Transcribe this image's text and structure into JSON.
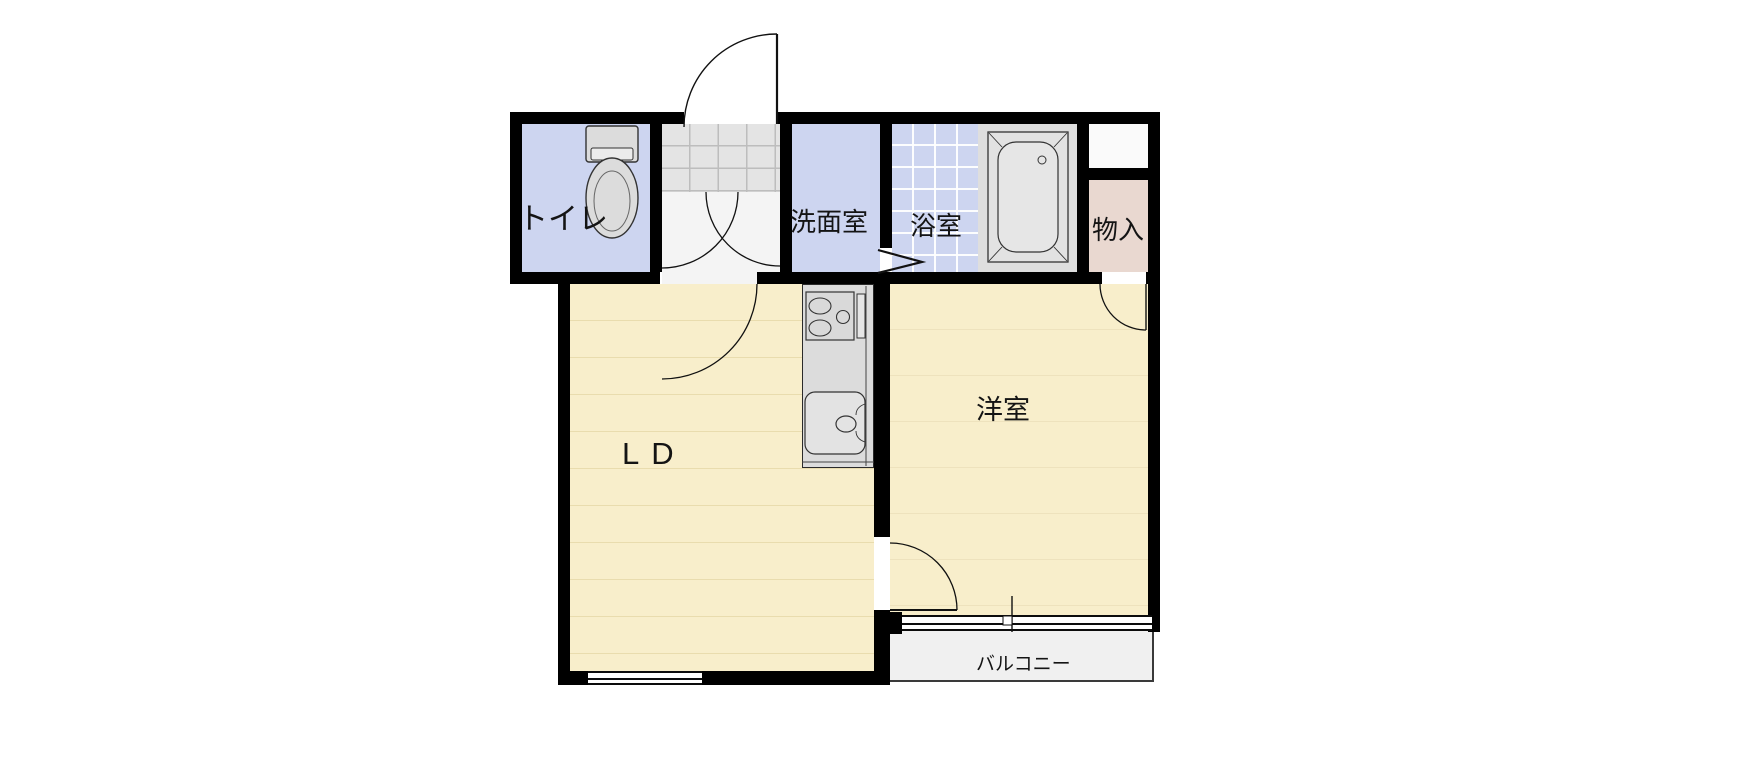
{
  "floorplan": {
    "type": "apartment-floor-plan",
    "rooms": {
      "toilet": {
        "label": "トイレ"
      },
      "washroom": {
        "label": "洗面室"
      },
      "bathroom": {
        "label": "浴室"
      },
      "storage": {
        "label": "物入"
      },
      "living_dining": {
        "label": "LD"
      },
      "western_room": {
        "label": "洋室"
      },
      "balcony": {
        "label": "バルコニー"
      }
    },
    "fixtures": [
      "toilet-bowl",
      "bathtub",
      "stove-two-burner",
      "kitchen-sink",
      "entrance-tile"
    ],
    "colors": {
      "wet_room_blue": "#cdd5f0",
      "floor_cream": "#f8eecb",
      "storage_pink": "#e9d8d0",
      "genkan_tile": "#e4e4e4",
      "hall_gray": "#f4f4f4",
      "closet_white": "#fafafa",
      "counter_gray": "#dcdcdc",
      "bath_surround": "#dedede",
      "balcony_gray": "#f0f0f0",
      "wall_black": "#000000"
    }
  }
}
